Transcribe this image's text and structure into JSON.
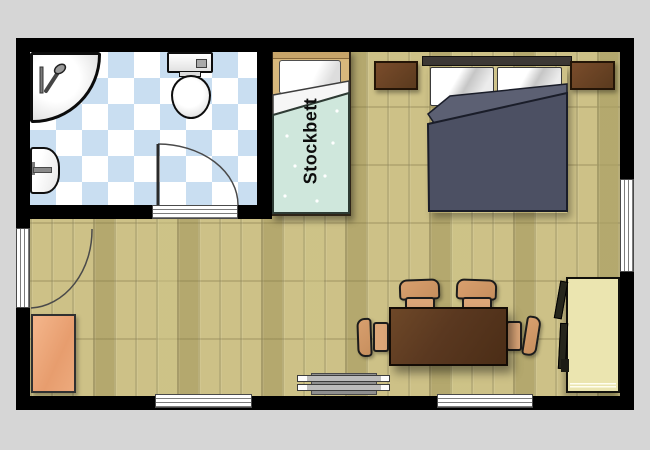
{
  "plan": {
    "type": "apartment-floor-plan",
    "labels": {
      "single_bed": "Stockbett"
    },
    "rooms": [
      {
        "name": "bathroom",
        "floor": "blue-white diagonal checker tile"
      },
      {
        "name": "main-room",
        "floor": "wood parquet"
      }
    ],
    "furniture": [
      {
        "name": "corner-shower"
      },
      {
        "name": "toilet"
      },
      {
        "name": "sink"
      },
      {
        "name": "single-bed",
        "label": "Stockbett"
      },
      {
        "name": "double-bed"
      },
      {
        "name": "nightstand-left"
      },
      {
        "name": "nightstand-right"
      },
      {
        "name": "sideboard"
      },
      {
        "name": "dining-table"
      },
      {
        "name": "chair",
        "count": 4
      },
      {
        "name": "radiator"
      },
      {
        "name": "wardrobe"
      },
      {
        "name": "entrance-door"
      },
      {
        "name": "bathroom-door"
      },
      {
        "name": "window",
        "count": 3
      }
    ],
    "colors": {
      "background": "#d6d6d6",
      "wall": "#000000",
      "wood_floor": "#cdc187",
      "tile_blue": "#c9def1",
      "single_duvet": "#cfe7dc",
      "double_duvet": "#4c5063",
      "nightstand_brown": "#6a4126",
      "table_brown": "#5a3820",
      "chair_tan": "#d89f6e",
      "sideboard_orange": "#e8a377",
      "wardrobe_cream": "#ebe5b0"
    }
  }
}
